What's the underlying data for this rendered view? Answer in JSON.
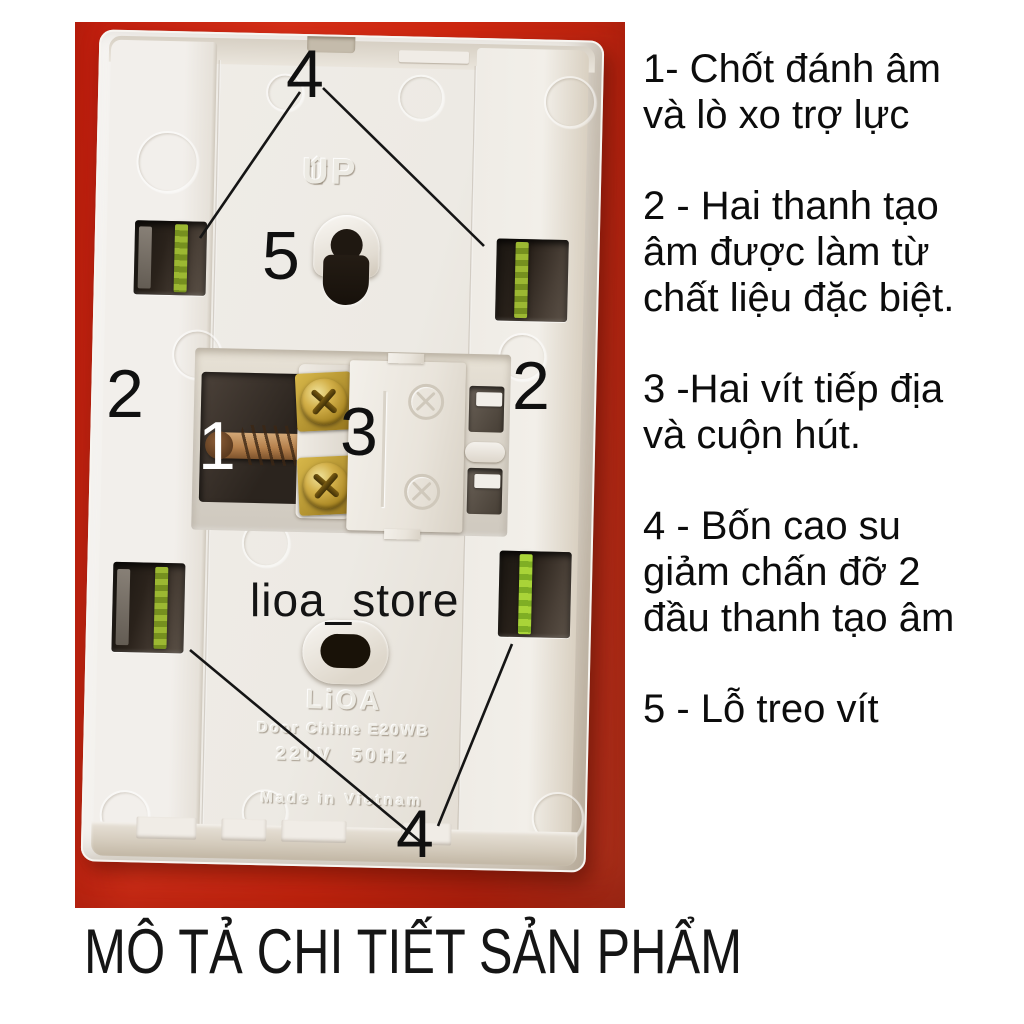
{
  "title": "MÔ TẢ CHI TIẾT SẢN PHẨM",
  "photo": {
    "watermark": "lioa_store",
    "colors": {
      "background_red": "#d62a12",
      "sound_bar_green": "#8fae2f",
      "brass_screw": "#c9a43a",
      "copper_pin": "#b5804c"
    },
    "device": {
      "up_label": "UP",
      "up_arrow": "⇧",
      "brand": "LiOA",
      "model": "Door Chime E20WB",
      "power": "220V  50Hz",
      "origin": "Made in Vietnam"
    },
    "callouts": {
      "top_dampers": "4",
      "hang_hole": "5",
      "left_bar": "2",
      "striker_pin": "1",
      "coil_cover": "3",
      "right_bar": "2",
      "bottom_dampers": "4"
    }
  },
  "legend": {
    "items": [
      {
        "text": "1- Chốt đánh âm\nvà lò xo trợ lực"
      },
      {
        "text": "2 - Hai thanh tạo\nâm được làm từ\nchất liệu đặc biệt."
      },
      {
        "text": "3 -Hai vít tiếp địa\nvà cuộn hút."
      },
      {
        "text": "4 - Bốn cao su\ngiảm chấn đỡ 2\nđầu thanh tạo âm"
      },
      {
        "text": "5 - Lỗ treo vít"
      }
    ]
  }
}
